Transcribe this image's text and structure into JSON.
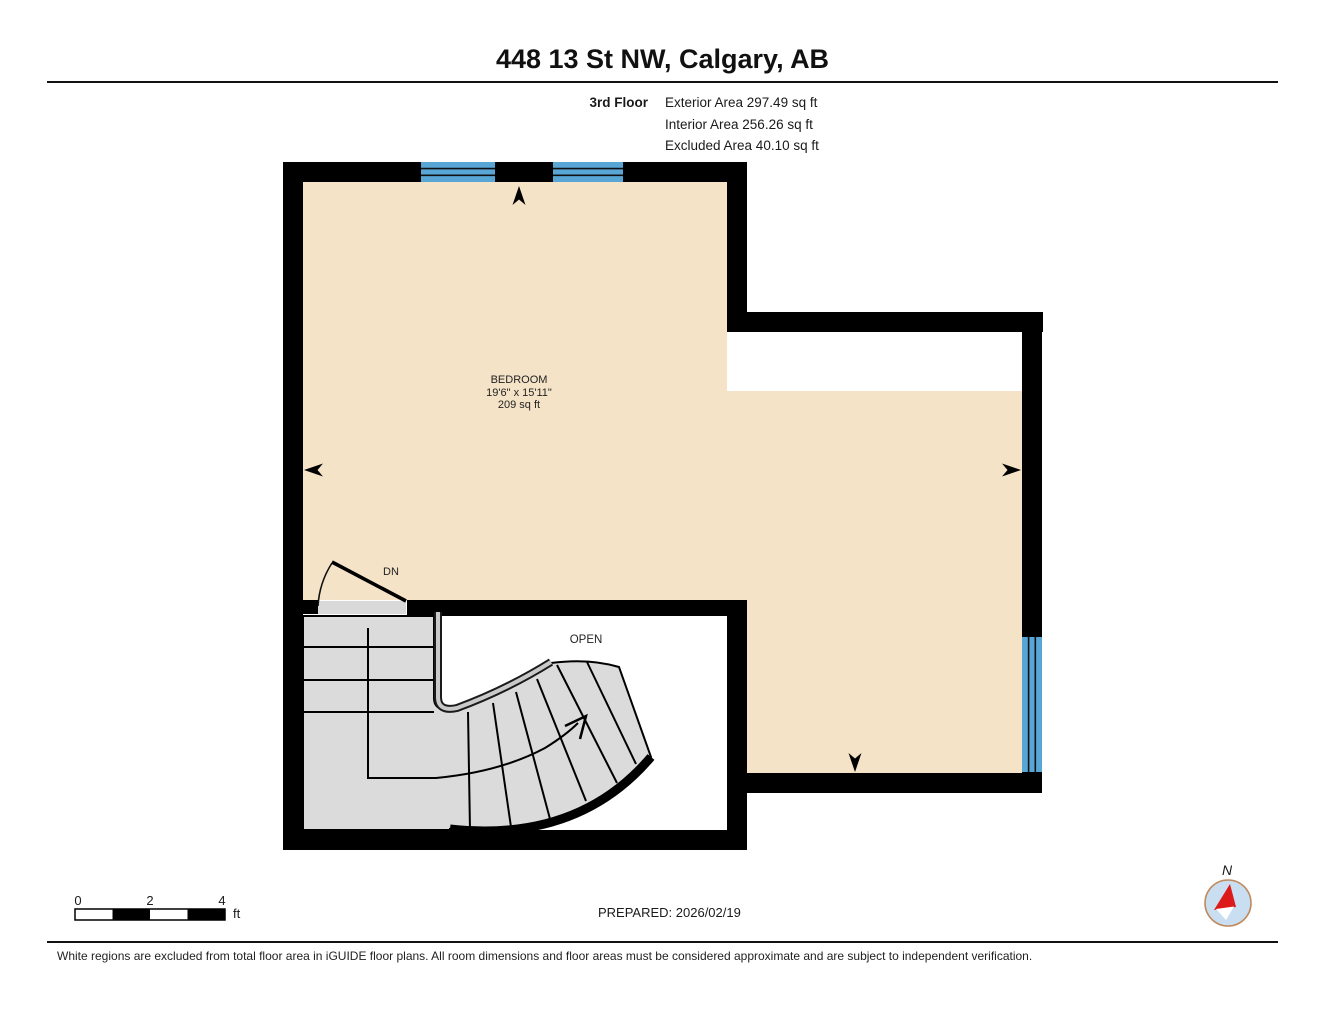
{
  "header": {
    "title": "448 13 St NW, Calgary, AB",
    "floor_label": "3rd Floor",
    "stats": [
      "Exterior Area 297.49 sq ft",
      "Interior Area 256.26 sq ft",
      "Excluded Area 40.10 sq ft"
    ]
  },
  "plan": {
    "room": {
      "name": "BEDROOM",
      "dims": "19'6\" x 15'11\"",
      "area": "209 sq ft"
    },
    "open_label": "OPEN",
    "stairs_down_label": "DN",
    "colors": {
      "interior_floor": "#F5E3C7",
      "wall": "#000000",
      "window": "#58A6D6",
      "stairs": "#DBDBDB",
      "excluded_region": "#FFFFFF"
    }
  },
  "footer": {
    "scale_ticks": [
      "0",
      "2",
      "4"
    ],
    "scale_unit": "ft",
    "prepared": "PREPARED: 2026/02/19",
    "compass_label": "N",
    "disclaimer": "White regions are excluded from total floor area in iGUIDE floor plans. All room dimensions and floor areas must be considered approximate and are subject to independent verification."
  }
}
